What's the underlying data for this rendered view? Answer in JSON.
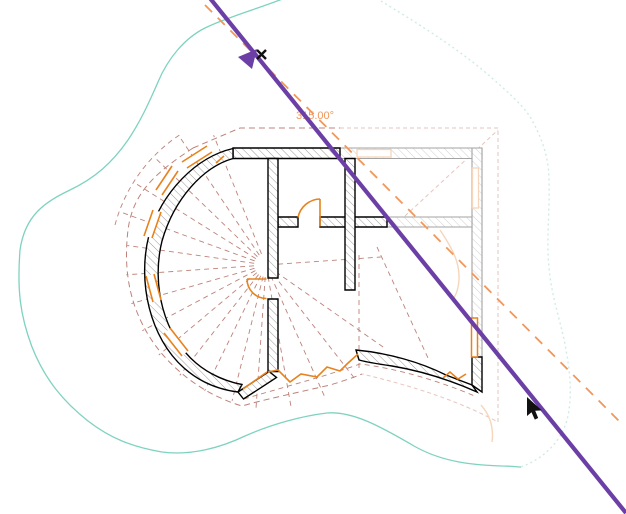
{
  "canvas": {
    "width": 626,
    "height": 514,
    "background": "#ffffff"
  },
  "angle_readout": {
    "text": "315.00°"
  },
  "icons": {
    "rotate_cursor": "purple-triangle-with-x-badge",
    "pointer_cursor": "black-arrow"
  },
  "colors": {
    "contour_solid": "#7fd2c0",
    "contour_faint": "#cfece4",
    "roof_dash": "#bd8279",
    "ghost_pink": "#e6c6bf",
    "ghost_peach": "#f6d6ba",
    "wall_black": "#000000",
    "wall_faded": "#a3a3a3",
    "hatch": "#9a9a9a",
    "hatch_faded": "#d0d0d0",
    "accent_orange": "#e8821c",
    "ray_orange": "#f2975a",
    "selection_purple": "#6b3fa6",
    "cursor_black": "#111111"
  }
}
